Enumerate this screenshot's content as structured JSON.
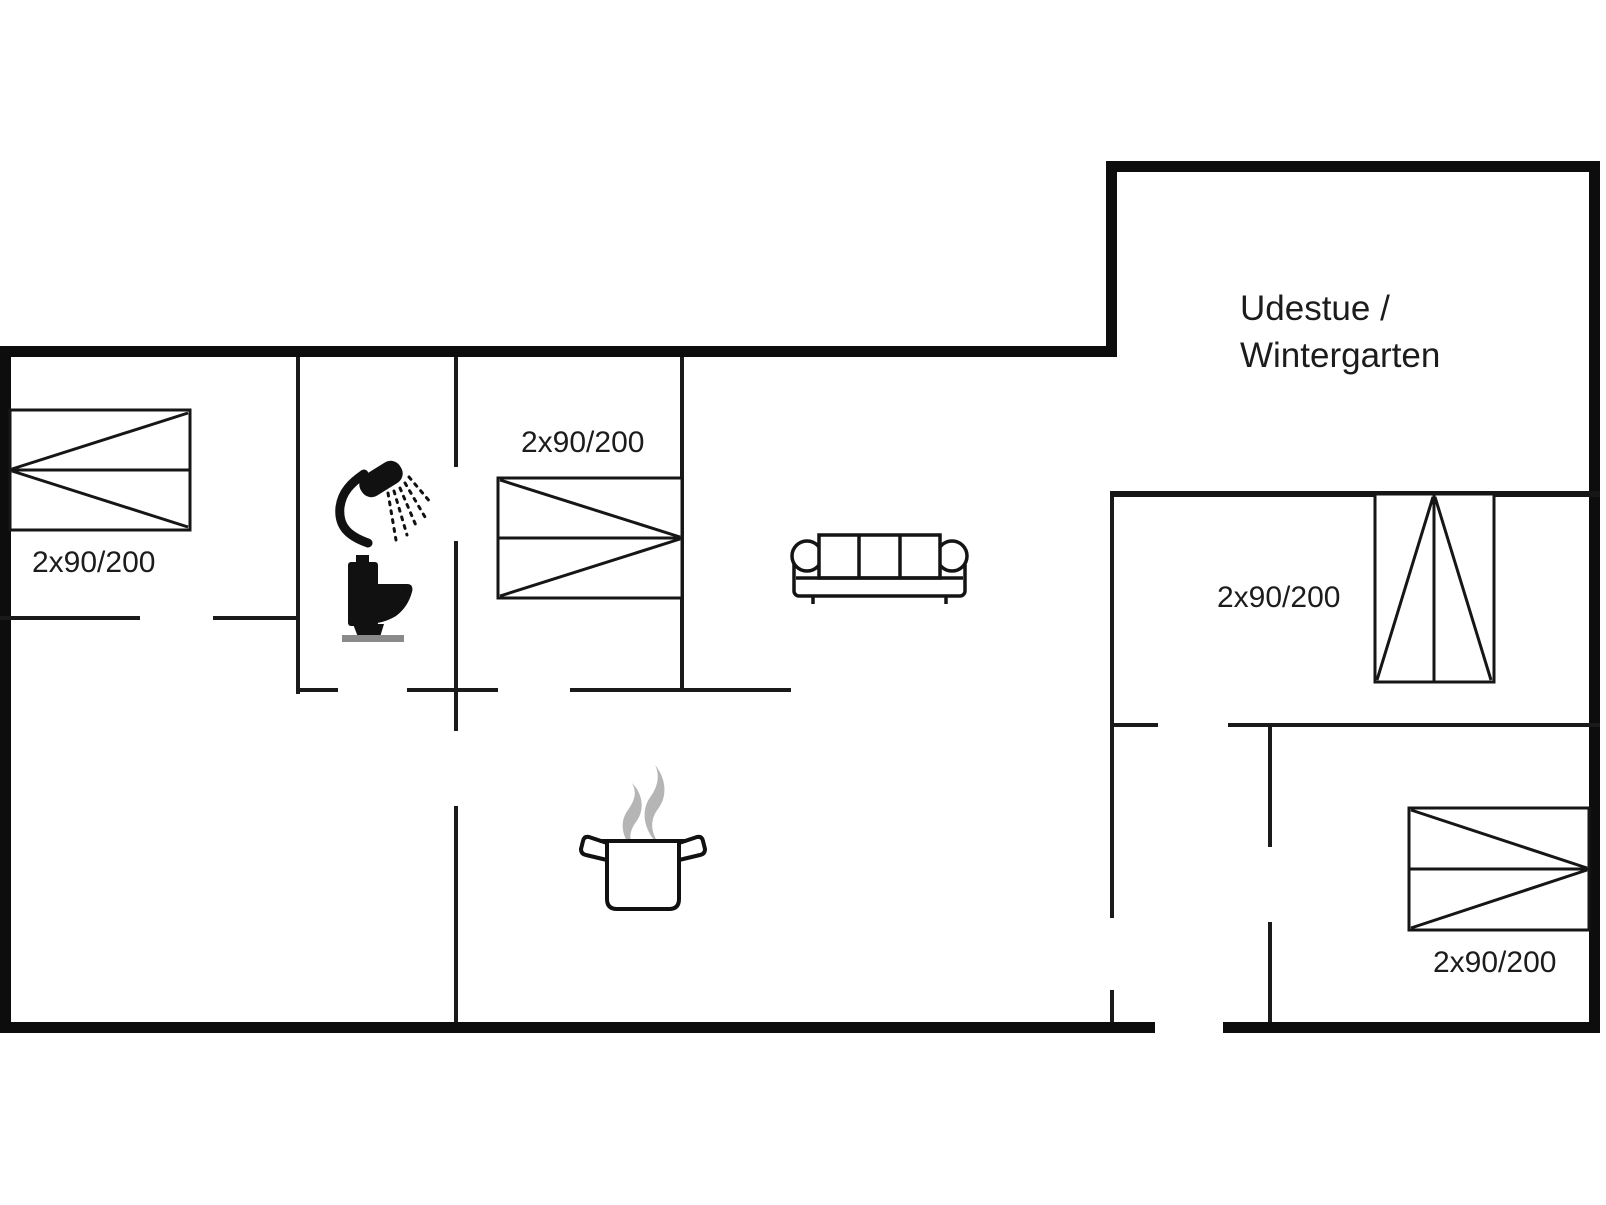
{
  "plan": {
    "type": "floor-plan",
    "colors": {
      "background": "#ffffff",
      "walls": "#0d0d0d",
      "furniture_line": "#161616",
      "label_text": "#1c1c1c",
      "steam": "#b5b5b5",
      "toilet_base": "#8a8a8a"
    },
    "rooms": {
      "sunroom": {
        "label_line1": "Udestue /",
        "label_line2": "Wintergarten"
      }
    },
    "beds": {
      "left_bedroom_label": "2x90/200",
      "middle_bedroom_label": "2x90/200",
      "right_top_bedroom_label": "2x90/200",
      "right_bottom_bedroom_label": "2x90/200"
    },
    "icons": {
      "shower": "shower-head-with-spray",
      "toilet": "toilet-side-view",
      "cooking_pot": "steaming-cooking-pot",
      "sofa": "three-seat-sofa",
      "bed_symbol": "double-bed-2x90-200"
    }
  }
}
